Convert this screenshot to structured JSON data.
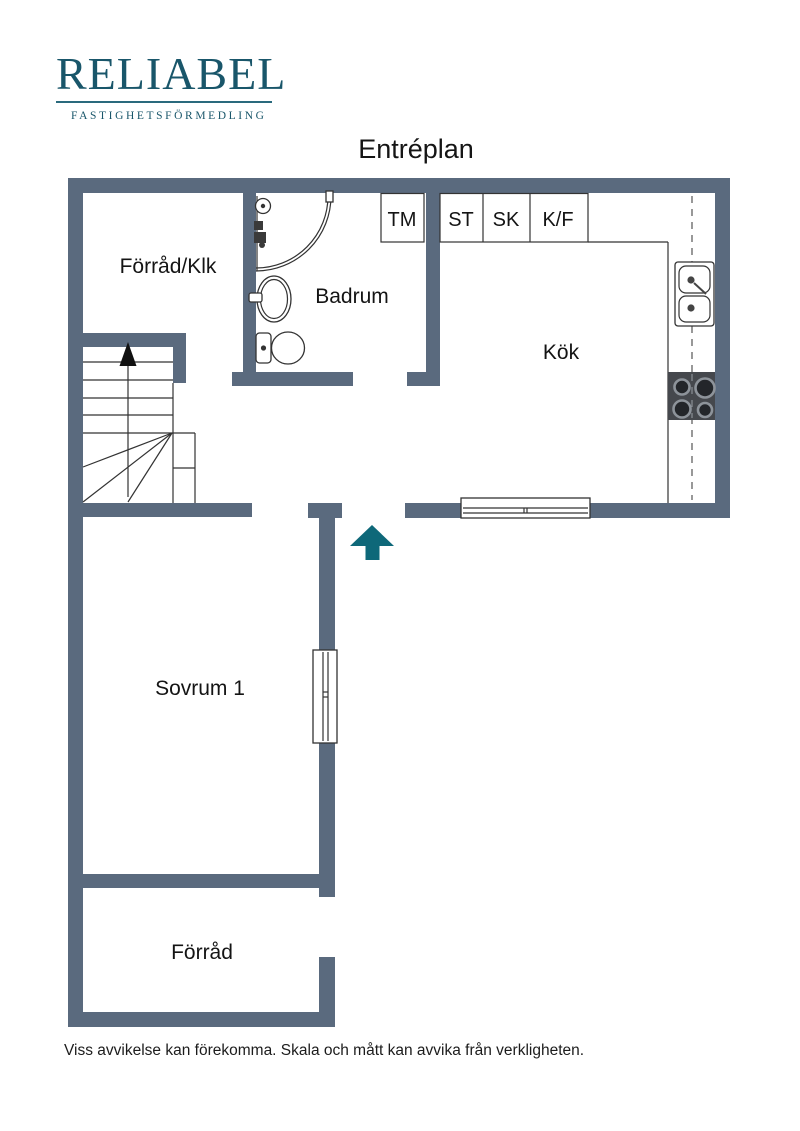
{
  "header": {
    "brand": "RELIABEL",
    "brand_sub": "FASTIGHETSFÖRMEDLING",
    "brand_color": "#19566a",
    "title": "Entréplan"
  },
  "floorplan": {
    "wall_color": "#5a6a7e",
    "arrow_color": "#0e6879",
    "rooms": {
      "forrad_klk": "Förråd/Klk",
      "badrum": "Badrum",
      "kok": "Kök",
      "sovrum1": "Sovrum 1",
      "forrad": "Förråd"
    },
    "appliances": {
      "tm": "TM",
      "st": "ST",
      "sk": "SK",
      "kf": "K/F"
    }
  },
  "footer": {
    "disclaimer": "Viss avvikelse kan förekomma. Skala och mått kan avvika från verkligheten."
  }
}
